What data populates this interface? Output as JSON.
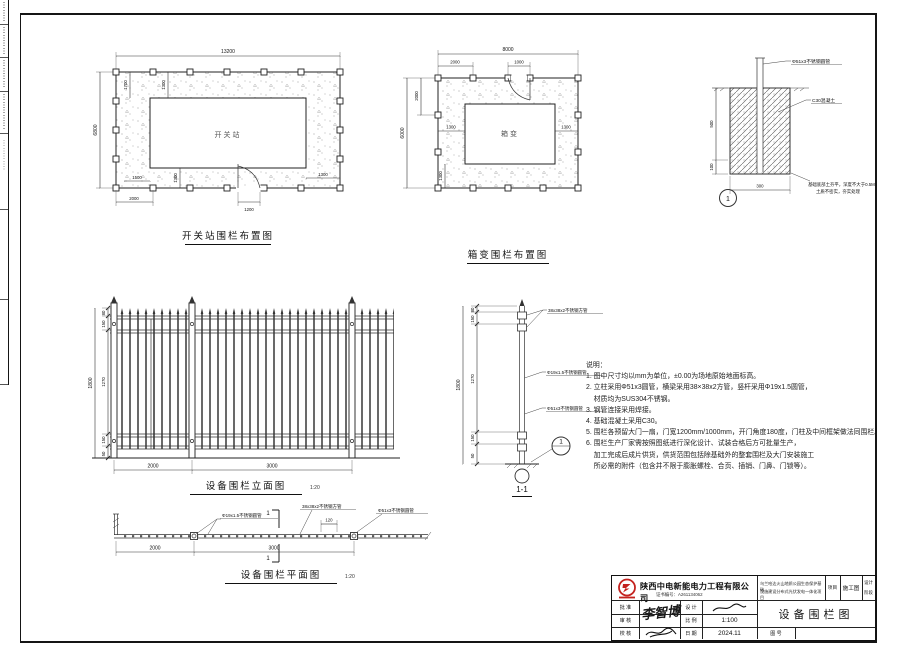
{
  "switch_plan": {
    "title": "开关站围栏布置图",
    "room": "开关站",
    "dim_top": "13200",
    "dim_left": "6800",
    "dim_1700": "1700",
    "dim_1300": "1300",
    "dim_1500": "1500",
    "dim_2000": "2000",
    "dim_1200": "1200"
  },
  "box_plan": {
    "title": "箱变围栏布置图",
    "room": "箱变",
    "dim_top": "8000",
    "dim_left": "6000",
    "dim_2000": "2000",
    "dim_1000": "1000",
    "dim_1300": "1300"
  },
  "detail": {
    "bubble": "1",
    "label_pipe": "Φ51x3不锈钢圆管",
    "label_concrete": "C30混凝土",
    "note1": "基础底部土夯平，深度不大于0.5M",
    "note2": "土质不密实，夯实处理",
    "dim_500": "500",
    "dim_100": "100",
    "dim_300": "300"
  },
  "elevation": {
    "title": "设备围栏立面图",
    "scale": "1:20",
    "dim_overall": "1800",
    "dim_80": "80",
    "dim_150": "150",
    "dim_1270": "1270",
    "dim_50": "50",
    "dim_bay1": "2000",
    "dim_bay2": "3000"
  },
  "section": {
    "title": "1-1",
    "bubble": "1",
    "label_rail": "38x38x2不锈钢方管",
    "label_picket": "Φ19x1.5不锈钢圆管",
    "label_post": "Φ51x3不锈钢圆管",
    "dim_overall": "1800",
    "dim_80": "80",
    "dim_150": "150",
    "dim_1270": "1270",
    "dim_50": "50"
  },
  "plan_view": {
    "title": "设备围栏平面图",
    "scale": "1:20",
    "label_picket": "Φ19x1.5不锈钢圆管",
    "label_rail": "38x38x2不锈钢方管",
    "label_post": "Φ51x3不锈钢圆管",
    "dim_120": "120",
    "dim_bay1": "2000",
    "dim_bay2": "3000",
    "section_mark": "1"
  },
  "notes": {
    "heading": "说明：",
    "lines": [
      "1. 图中尺寸均以mm为单位，±0.00为场地原始地面标高。",
      "2. 立柱采用Φ51x3圆管，横梁采用38×38x2方管，竖杆采用Φ19x1.5圆管，",
      "    材质均为SUS304不锈钢。",
      "3. 钢管连接采用焊接。",
      "4. 基础混凝土采用C30。",
      "5. 围栏各预留大门一扇，门宽1200mm/1000mm，开门角度180度，门柱及中间框架做法同围栏。",
      "6. 围栏生产厂家需按照图纸进行深化设计、试装合格后方可批量生产，",
      "    加工完成后成片供货，供货范围包括除基础外的整套围栏及大门安装施工",
      "    所必需的附件（包含并不限于膨胀螺栓、合页、插销、门鼻、门锁等）。"
    ]
  },
  "title_block": {
    "company": "陕西中电新能电力工程有限公司",
    "cert": "证书编号：A261134062",
    "project_line1": "乌兰哈达火山地质公园生态保护基础",
    "project_line2": "设施建设分布式光伏发电一体化项目",
    "project_label": "项目",
    "stage": "施工图",
    "phase1": "设计",
    "phase2": "阶段",
    "row_approve": "批 准",
    "row_check": "审 核",
    "row_review": "校 核",
    "col_design": "设 计",
    "col_scale": "比 例",
    "col_date": "日 期",
    "signature": "李智博",
    "scale_value": "1:100",
    "date_value": "2024.11",
    "drawing_title": "设备围栏图",
    "drawing_no_label": "图 号",
    "logo_color": "#c4221f"
  }
}
